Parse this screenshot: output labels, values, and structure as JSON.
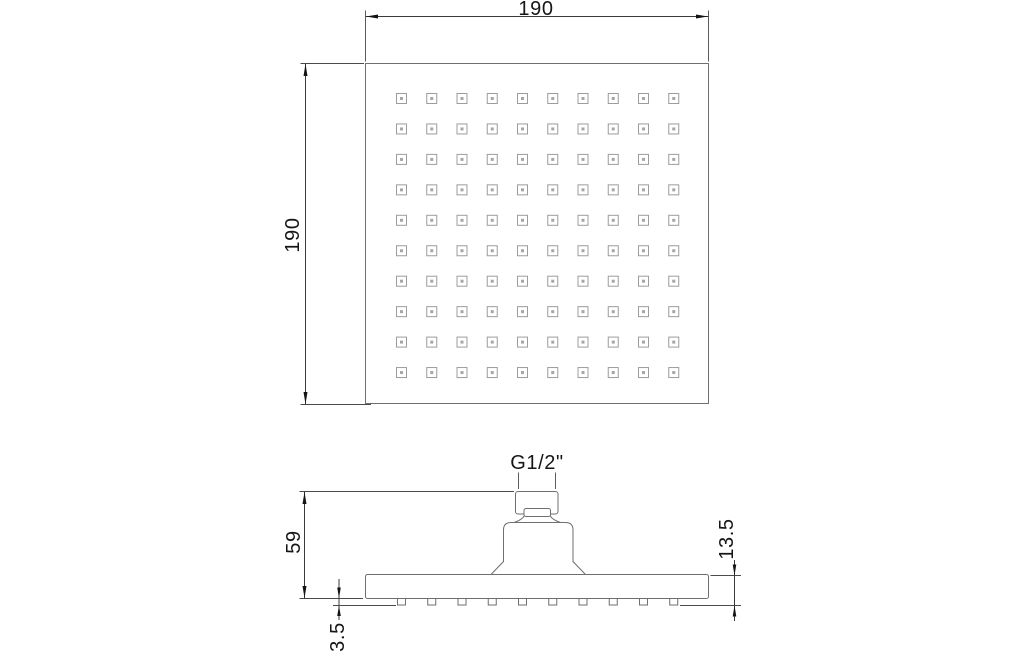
{
  "drawing": {
    "views": {
      "top": {
        "name": "top view",
        "width_dim": "190",
        "height_dim": "190",
        "nozzle_grid": {
          "rows": 10,
          "cols": 10
        }
      },
      "side": {
        "name": "side view",
        "thread_dim": "G1/2\"",
        "overall_height_dim": "59",
        "nozzle_height_dim": "3.5",
        "edge_thickness_dim": "13.5",
        "nozzle_count": 10
      }
    }
  },
  "geometry": {
    "top_grid": {
      "start_x": 401.5,
      "start_y": 98.5,
      "step_x": 30.25,
      "step_y": 30.45
    },
    "side_tabs": {
      "start_x": 401.5,
      "y": 598.5,
      "width": 8,
      "height": 6.5,
      "step_x": 30.25
    }
  },
  "colors": {
    "background": "#ffffff",
    "outline": "#6f6f6f",
    "nozzle": "#9c9c9c",
    "dimension": "#3a3a3a",
    "text": "#161616"
  }
}
